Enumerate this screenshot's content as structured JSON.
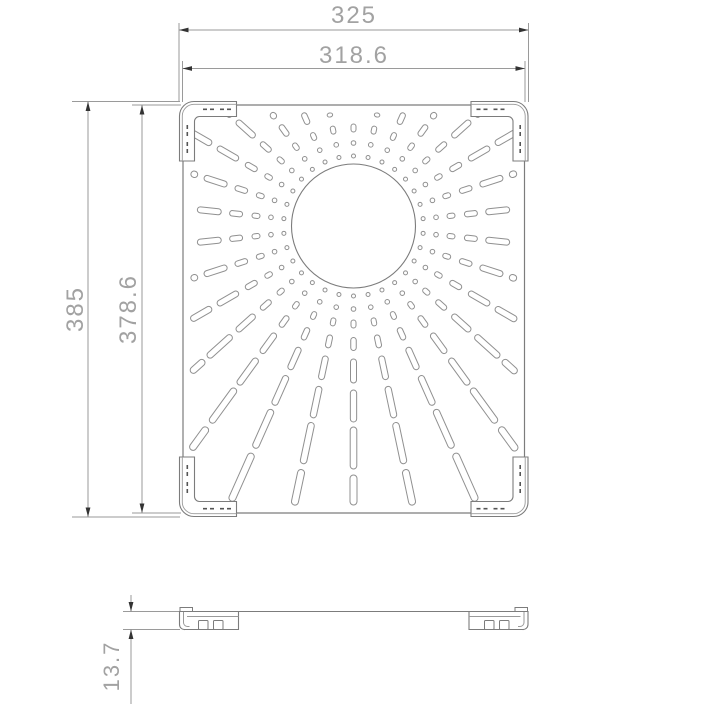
{
  "style": {
    "background": "#ffffff",
    "line_color": "#9a9a9a",
    "outline_color": "#7c7c7c",
    "pattern_color": "#909090",
    "arrow_color": "#333333",
    "text_color": "#a2a2a2"
  },
  "dimensions": {
    "top_outer": {
      "label": "325",
      "orientation": "horizontal"
    },
    "top_inner": {
      "label": "318.6",
      "orientation": "horizontal"
    },
    "left_outer": {
      "label": "385",
      "orientation": "vertical"
    },
    "left_inner": {
      "label": "378.6",
      "orientation": "vertical"
    },
    "side_thickness": {
      "label": "13.7",
      "orientation": "vertical"
    }
  },
  "geometry": {
    "front_view": {
      "rect": {
        "x": 183,
        "y": 105,
        "w": 341.5,
        "h": 408,
        "corner_r": 4
      },
      "circle": {
        "cx": 353.5,
        "cy": 226,
        "r": 62
      },
      "pattern": {
        "ray_start_deg": 90,
        "ray_step_deg": 12,
        "ray_count": 30,
        "edge_margin": 8,
        "rings": [
          {
            "r": 70,
            "kind": "dot",
            "d": 4.0
          },
          {
            "r": 83,
            "kind": "dot",
            "d": 4.6
          },
          {
            "r": 98,
            "kind": "slot",
            "half": 4,
            "w": 5.0
          },
          {
            "r": 118,
            "kind": "slot",
            "half": 6.5,
            "w": 5.5
          },
          {
            "r": 145,
            "kind": "slot",
            "half": 12,
            "w": 6.0
          },
          {
            "r": 180,
            "kind": "slot",
            "half": 16,
            "w": 6.3
          },
          {
            "r": 222,
            "kind": "slot",
            "half": 21,
            "w": 6.6
          },
          {
            "r": 275,
            "kind": "slot",
            "half": 26,
            "w": 7.0
          },
          {
            "r": 338,
            "kind": "slot",
            "half": 30,
            "w": 7.0
          }
        ]
      },
      "mirror_x": 707.5,
      "mirror_y": 618
    },
    "side_view": {
      "top_y": 611.5,
      "bottom_y": 629.5,
      "left_x": 179.5,
      "right_x": 528,
      "foot_w": 59
    },
    "dim_lines": [
      {
        "name": "dim-line-325",
        "lines": [
          [
            179,
            30,
            528.5,
            30
          ]
        ],
        "ext": [
          [
            179,
            23,
            179,
            102
          ],
          [
            528.5,
            23,
            528.5,
            102
          ]
        ],
        "arrows": [
          [
            179,
            30,
            0
          ],
          [
            528.5,
            30,
            180
          ]
        ]
      },
      {
        "name": "dim-line-318-6",
        "lines": [
          [
            182.5,
            68.5,
            525,
            68.5
          ]
        ],
        "ext": [
          [
            182.5,
            61,
            182.5,
            102
          ],
          [
            525,
            61,
            525,
            102
          ]
        ],
        "arrows": [
          [
            182.5,
            68.5,
            0
          ],
          [
            525,
            68.5,
            180
          ]
        ]
      },
      {
        "name": "dim-line-385",
        "lines": [
          [
            88,
            101.5,
            88,
            517
          ]
        ],
        "ext": [
          [
            72,
            101.5,
            180,
            101.5
          ],
          [
            72,
            517,
            180,
            517
          ]
        ],
        "arrows": [
          [
            88,
            101.5,
            90
          ],
          [
            88,
            517,
            270
          ]
        ]
      },
      {
        "name": "dim-line-378-6",
        "lines": [
          [
            142,
            105,
            142,
            513
          ]
        ],
        "ext": [
          [
            132,
            105,
            181,
            105
          ],
          [
            132,
            513,
            181,
            513
          ]
        ],
        "arrows": [
          [
            142,
            105,
            90
          ],
          [
            142,
            513,
            270
          ]
        ]
      },
      {
        "name": "dim-line-13-7",
        "lines": [
          [
            131,
            595,
            131,
            611.5
          ],
          [
            131,
            629.5,
            131,
            704
          ]
        ],
        "ext": [
          [
            123,
            611.5,
            180,
            611.5
          ],
          [
            123,
            629.5,
            180,
            629.5
          ]
        ],
        "arrows": [
          [
            131,
            611.5,
            270
          ],
          [
            131,
            629.5,
            90
          ]
        ]
      }
    ]
  }
}
